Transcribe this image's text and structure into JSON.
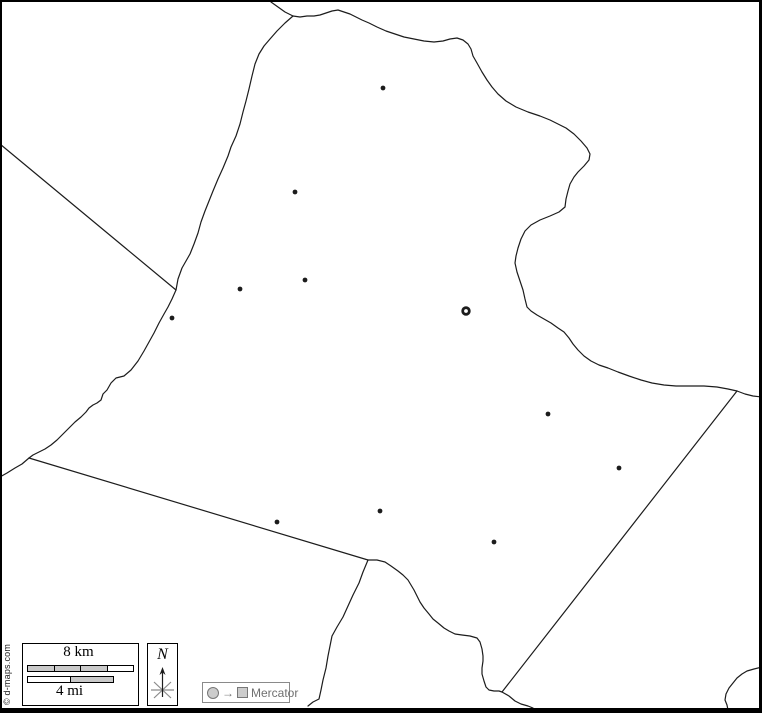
{
  "attribution": "© d-maps.com",
  "scalebar": {
    "km_label": "8 km",
    "mi_label": "4 mi"
  },
  "compass": {
    "north_label": "N"
  },
  "legend": {
    "arrow_glyph": "→",
    "projection": "Mercator"
  },
  "colors": {
    "boundary": "#1c1c1c",
    "background": "#ffffff",
    "scale_fill": "#c9c9c9",
    "legend_gray": "#707070"
  },
  "markers": {
    "capital": {
      "x": 466,
      "y": 311
    },
    "towns": [
      {
        "x": 383,
        "y": 88
      },
      {
        "x": 295,
        "y": 192
      },
      {
        "x": 305,
        "y": 280
      },
      {
        "x": 240,
        "y": 289
      },
      {
        "x": 172,
        "y": 318
      },
      {
        "x": 548,
        "y": 414
      },
      {
        "x": 619,
        "y": 468
      },
      {
        "x": 380,
        "y": 511
      },
      {
        "x": 277,
        "y": 522
      },
      {
        "x": 494,
        "y": 542
      }
    ]
  },
  "outline_paths": {
    "top_entry": "M271,2 L278,7 L285,12 L293,16",
    "north_east_boundary": "M293,16 L300,17 L307,16 L314,16 L320,15 L326,13 L332,11 L338,10 L344,12 L350,14 L356,17 L362,20 L369,23 L377,27 L386,31 L395,34 L404,37 L414,39 L424,41 L434,42 L443,41 L450,39 L457,38 L463,40 L468,44 L471,49 L473,56 L477,63 L482,72 L487,80 L492,87 L498,94 L506,101 L516,107 L528,112 L540,116 L550,120 L558,124 L566,128 L574,134 L581,141 L587,148 L590,154 L589,160 L584,166 L578,172 L574,177 L570,184 L568,191 L566,199 L565,207 L559,212 L550,216 L540,220 L531,225 L525,231 L521,239 L518,248 L516,256 L515,263 L517,272 L520,281 L523,290 L525,299 L527,307 L531,311 L537,315 L544,319 L551,323 L558,328 L564,332 L569,338 L573,344 L578,350 L584,356 L591,361 L599,365 L608,368 L618,372 L629,376 L641,380 L652,383 L664,385 L676,386 L690,386 L704,386 L717,387 L728,389 L737,391",
    "east_exit": "M737,391 L745,394 L753,396 L762,397",
    "west_boundary": "M293,16 L285,23 L277,31 L270,39 L264,46 L259,54 L255,64 L252,76 L249,89 L246,101 L243,112 L240,124 L236,136 L231,147 L228,156 L223,168 L218,179 L213,191 L209,201 L205,211 L201,222 L198,233 L194,244 L190,254 L186,261 L182,268 L178,279 L176,290 L172,299 L168,307 L164,314 L159,323 L154,333 L149,342 L144,351 L138,361 L131,370 L124,376 L116,378 L111,383 L107,390 L103,394 L101,400 L97,403 L93,405 L89,408 L86,412 L81,417 L75,422 L69,428 L63,434 L57,440 L51,445 L45,449 L39,452 L33,455 L29,458",
    "west_exit": "M29,458 L22,464 L15,468 L7,473 L0,477",
    "nw_neighbor_line": "M0,144 L176,290",
    "sw_boundary_straight": "M29,458 L368,560",
    "south_neighbor_wiggle": "M368,560 L363,572 L359,583 L353,595 L348,606 L343,617 L337,627 L332,636 L330,646 L328,656 L326,668 L323,680 L321,690 L319,699 L313,702 L308,706",
    "south_boundary_wiggle": "M368,560 L377,560 L385,562 L391,566 L398,571 L403,575 L408,580 L411,585 L414,590 L417,596 L420,602 L424,608 L429,614 L433,619 L438,623 L444,628 L449,631 L455,634 L462,635 L470,636 L477,638 L480,642 L482,649 L483,656 L483,661 L482,668 L482,674 L484,681 L486,687 L489,690 L494,691 L499,691 L502,692 L509,696 L515,701 L521,704 L528,706 L533,708",
    "se_boundary_straight": "M502,692 L737,391",
    "bottom_right_squiggle": "M762,667 L754,669 L747,671 L742,674 L737,678 L733,683 L729,688 L726,694 L725,700 L727,705 L728,710"
  }
}
